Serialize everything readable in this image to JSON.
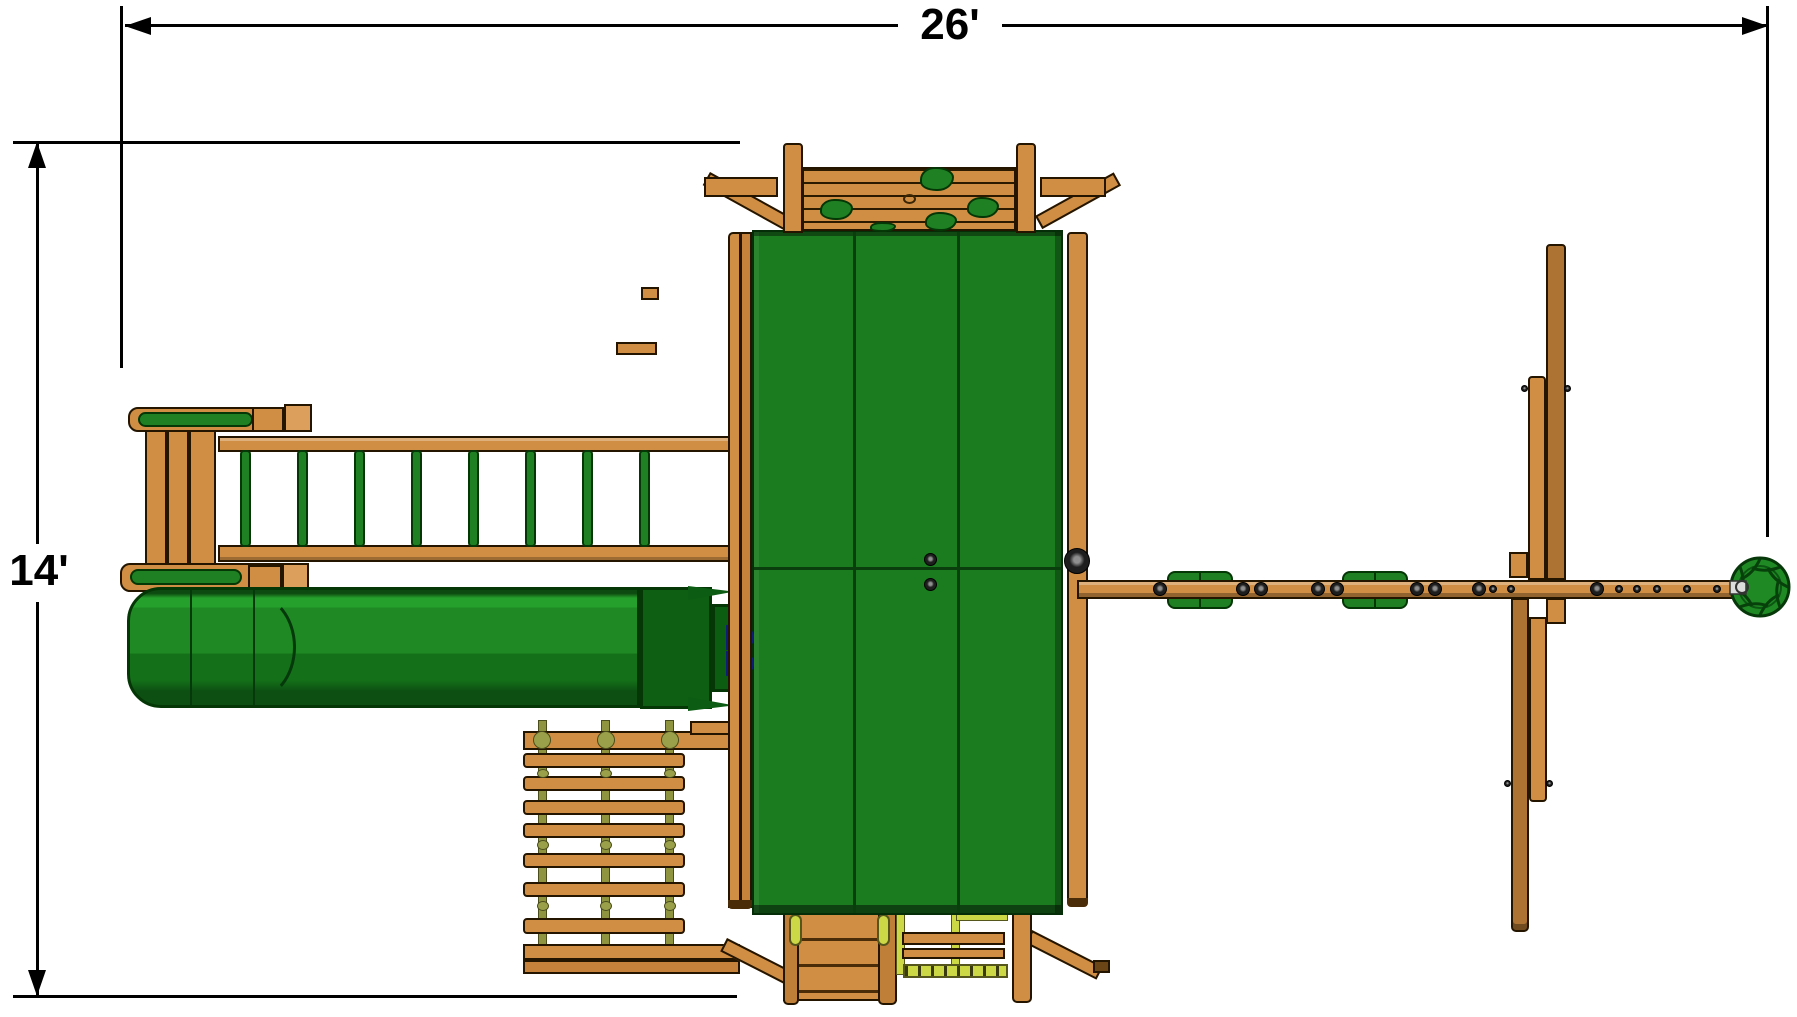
{
  "diagram": {
    "dimensions": {
      "width_label": "26'",
      "height_label": "14'"
    },
    "colors": {
      "wood": "#D08E44",
      "wood_dark": "#AD7332",
      "wood_deep": "#8F5B22",
      "outline": "#241500",
      "canopy": "#1B7B1F",
      "canopy_seam": "#0B3E0D",
      "slide": "#1F8A24",
      "slide_dark": "#0E5F14",
      "green_part": "#1E8023",
      "green_edge": "#053606",
      "blue": "#2437D4",
      "rope": "#8F9440",
      "rope_y": "#CCD845",
      "dim": "#000000"
    }
  }
}
